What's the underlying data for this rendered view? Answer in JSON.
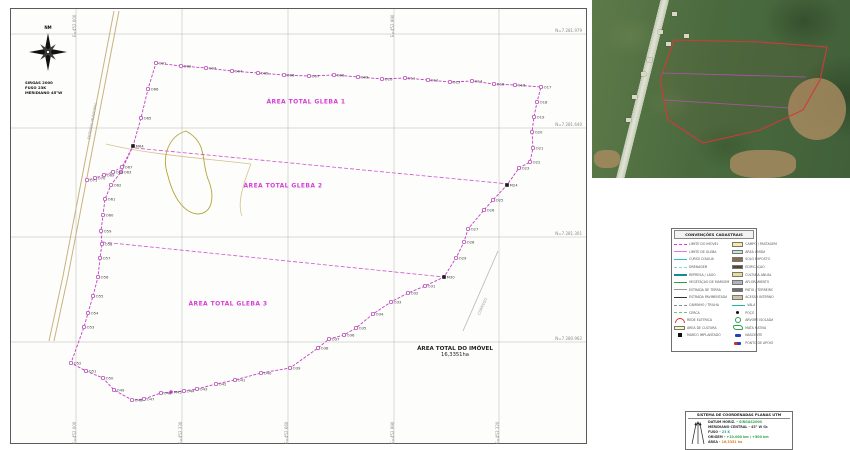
{
  "accent_colors": {
    "boundary": "#c43fc4",
    "gleba_text": "#d63fd6",
    "grid": "#b5b5b5",
    "road": "#c9b37e",
    "pond": "#b4a43c",
    "inset_boundary": "#d03a3a"
  },
  "compass": {
    "north_label": "NM",
    "datum_lines": [
      "SIRGAS 2000",
      "FUSO 23K",
      "MERIDIANO 45°W"
    ]
  },
  "map": {
    "gleba_labels": [
      {
        "text": "ÁREA TOTAL GLEBA 1",
        "x": 295,
        "y": 93
      },
      {
        "text": "ÁREA TOTAL GLEBA 2",
        "x": 272,
        "y": 177
      },
      {
        "text": "ÁREA TOTAL GLEBA 3",
        "x": 217,
        "y": 295
      }
    ],
    "area_label": {
      "line1": "ÁREA TOTAL DO IMÓVEL",
      "line2": "16,3351ha"
    },
    "road_label": "ESTRADA MUNICIPAL",
    "stream_label": "CÓRREGO",
    "grid": {
      "vertical_x": [
        65,
        171,
        277,
        383,
        488
      ],
      "horizontal_y": [
        25,
        119,
        228,
        333
      ],
      "north_labels": [
        "N=7.281.979",
        "N=7.281.640",
        "N=7.281.301",
        "N=7.280.962"
      ],
      "east_labels": [
        "E=452.000",
        "E=452.330",
        "E=452.660",
        "E=452.990",
        "E=453.320"
      ]
    },
    "shapes": {
      "road1": "M103,2 L78,132 L52,267 L38,332",
      "road2": "M108,2 L83,132 L57,267 L43,332",
      "pond": "M175,122 C158,127 150,147 157,167 C162,187 172,204 187,205 C202,204 204,187 197,170 C190,152 197,134 175,122 Z",
      "stream1": "M95,135 C140,146 200,150 240,155",
      "stream2": "M240,155 C232,175 226,195 231,207",
      "gray_stream": "M487,242 L452,322"
    },
    "division_lines": [
      [
        124,
        139,
        498,
        175
      ],
      [
        91,
        233,
        433,
        268
      ]
    ],
    "points": [
      [
        145,
        54,
        "O01",
        "o"
      ],
      [
        170,
        57,
        "O02",
        "o"
      ],
      [
        195,
        59,
        "O03",
        "o"
      ],
      [
        221,
        62,
        "O04",
        "o"
      ],
      [
        247,
        64,
        "O05",
        "o"
      ],
      [
        273,
        66,
        "O06",
        "o"
      ],
      [
        298,
        67,
        "O07",
        "o"
      ],
      [
        323,
        66,
        "O08",
        "o"
      ],
      [
        347,
        68,
        "O09",
        "o"
      ],
      [
        371,
        70,
        "O10",
        "o"
      ],
      [
        394,
        69,
        "O11",
        "o"
      ],
      [
        417,
        71,
        "O12",
        "o"
      ],
      [
        439,
        73,
        "O13",
        "o"
      ],
      [
        461,
        72,
        "O14",
        "o"
      ],
      [
        483,
        75,
        "O15",
        "o"
      ],
      [
        504,
        76,
        "O16",
        "o"
      ],
      [
        530,
        78,
        "O17",
        "o"
      ],
      [
        526,
        93,
        "O18",
        "o"
      ],
      [
        523,
        108,
        "O19",
        "o"
      ],
      [
        521,
        123,
        "O20",
        "o"
      ],
      [
        522,
        139,
        "O21",
        "o"
      ],
      [
        519,
        153,
        "O22",
        "o"
      ],
      [
        508,
        159,
        "O23",
        "o"
      ],
      [
        496,
        176,
        "M24",
        "m"
      ],
      [
        482,
        191,
        "O25",
        "o"
      ],
      [
        473,
        201,
        "O26",
        "o"
      ],
      [
        457,
        220,
        "O27",
        "o"
      ],
      [
        453,
        233,
        "O28",
        "o"
      ],
      [
        445,
        249,
        "O29",
        "o"
      ],
      [
        433,
        268,
        "M30",
        "m"
      ],
      [
        414,
        277,
        "O31",
        "o"
      ],
      [
        397,
        284,
        "O32",
        "o"
      ],
      [
        380,
        293,
        "O33",
        "o"
      ],
      [
        362,
        305,
        "O34",
        "o"
      ],
      [
        345,
        319,
        "O35",
        "o"
      ],
      [
        333,
        326,
        "O36",
        "o"
      ],
      [
        318,
        330,
        "O37",
        "o"
      ],
      [
        307,
        339,
        "O38",
        "o"
      ],
      [
        279,
        359,
        "O39",
        "o"
      ],
      [
        250,
        364,
        "O40",
        "o"
      ],
      [
        224,
        371,
        "O41",
        "o"
      ],
      [
        205,
        375,
        "O42",
        "o"
      ],
      [
        186,
        380,
        "O43",
        "o"
      ],
      [
        173,
        382,
        "O44",
        "o"
      ],
      [
        160,
        383,
        "M45",
        "f"
      ],
      [
        150,
        384,
        "O46",
        "o"
      ],
      [
        133,
        390,
        "O47",
        "o"
      ],
      [
        121,
        391,
        "O48",
        "o"
      ],
      [
        103,
        381,
        "O49",
        "o"
      ],
      [
        92,
        369,
        "O50",
        "o"
      ],
      [
        75,
        362,
        "O51",
        "o"
      ],
      [
        60,
        354,
        "O52",
        "o"
      ],
      [
        73,
        318,
        "O53",
        "o"
      ],
      [
        77,
        304,
        "O54",
        "o"
      ],
      [
        82,
        287,
        "O55",
        "o"
      ],
      [
        87,
        268,
        "O56",
        "o"
      ],
      [
        89,
        249,
        "O57",
        "o"
      ],
      [
        91,
        235,
        "O58",
        "o"
      ],
      [
        90,
        222,
        "O59",
        "o"
      ],
      [
        92,
        206,
        "O60",
        "o"
      ],
      [
        94,
        190,
        "O61",
        "o"
      ],
      [
        100,
        176,
        "O62",
        "o"
      ],
      [
        110,
        163,
        "O63",
        "o"
      ],
      [
        122,
        137,
        "M64",
        "m"
      ],
      [
        130,
        109,
        "O65",
        "o"
      ],
      [
        137,
        80,
        "O66",
        "o"
      ]
    ],
    "spur_points": [
      [
        111,
        158,
        "O67",
        "o"
      ],
      [
        102,
        163,
        "O68",
        "o"
      ],
      [
        93,
        166,
        "O69",
        "o"
      ],
      [
        84,
        169,
        "O70",
        "o"
      ],
      [
        76,
        171,
        "O71",
        "o"
      ]
    ]
  },
  "inset": {
    "boundary": [
      [
        82,
        40
      ],
      [
        168,
        42
      ],
      [
        235,
        47
      ],
      [
        228,
        80
      ],
      [
        211,
        110
      ],
      [
        168,
        130
      ],
      [
        111,
        143
      ],
      [
        76,
        120
      ],
      [
        68,
        80
      ]
    ],
    "division_lines": [
      [
        70,
        73,
        214,
        77
      ],
      [
        72,
        100,
        198,
        108
      ]
    ],
    "buildings": [
      [
        80,
        12
      ],
      [
        66,
        30
      ],
      [
        74,
        42
      ],
      [
        55,
        58
      ],
      [
        49,
        72
      ],
      [
        40,
        95
      ],
      [
        34,
        118
      ],
      [
        92,
        34
      ]
    ],
    "fields": [
      {
        "x": 196,
        "y": 78,
        "w": 58,
        "h": 62,
        "r": "50%"
      },
      {
        "x": 138,
        "y": 150,
        "w": 66,
        "h": 28,
        "r": "40%"
      },
      {
        "x": 2,
        "y": 150,
        "w": 26,
        "h": 18,
        "r": "40%"
      }
    ]
  },
  "legend": {
    "title": "CONVENÇÕES CADASTRAIS",
    "left": [
      {
        "type": "line",
        "color": "#d040d0",
        "dash": true,
        "label": "LIMITE DO IMÓVEL"
      },
      {
        "type": "line",
        "color": "#e07ae0",
        "dash": false,
        "label": "LIMITE DE GLEBA"
      },
      {
        "type": "line",
        "color": "#25c2c2",
        "dash": false,
        "label": "CURSO D'ÁGUA"
      },
      {
        "type": "line",
        "color": "#7adada",
        "dash": true,
        "label": "DRENAGEM"
      },
      {
        "type": "line",
        "color": "#0f8f8f",
        "thick": true,
        "label": "REPRESA / LAGO"
      },
      {
        "type": "line",
        "color": "#2ca04a",
        "dash": false,
        "label": "VEGETAÇÃO DE MARGEM"
      },
      {
        "type": "line",
        "color": "#9a9a9a",
        "dash": false,
        "label": "ESTRADA DE TERRA"
      },
      {
        "type": "line",
        "color": "#333333",
        "dash": false,
        "label": "ESTRADA PAVIMENTADA"
      },
      {
        "type": "line",
        "color": "#8a8a8a",
        "dash": true,
        "label": "CAMINHO / TRILHA"
      },
      {
        "type": "line",
        "color": "#6fc46f",
        "dash": true,
        "label": "CERCA"
      },
      {
        "type": "sym",
        "shape": "arc",
        "color": "#d03030",
        "label": "REDE ELÉTRICA"
      },
      {
        "type": "patch",
        "color": "#fbf7b0",
        "label": "ÁREA DE CULTURA"
      },
      {
        "type": "sym",
        "shape": "sq",
        "color": "#111111",
        "label": "MARCO IMPLANTADO"
      }
    ],
    "right": [
      {
        "type": "patch",
        "color": "#f2eda0",
        "label": "CAMPO / PASTAGEM"
      },
      {
        "type": "patch",
        "color": "#bfe8e4",
        "label": "ÁREA ÚMIDA"
      },
      {
        "type": "patch",
        "color": "#8a6d4b",
        "label": "SOLO EXPOSTO"
      },
      {
        "type": "patch",
        "color": "#57452f",
        "label": "EDIFICAÇÃO"
      },
      {
        "type": "patch",
        "color": "#e8e08e",
        "label": "CULTURA ANUAL"
      },
      {
        "type": "patch",
        "color": "#b5b5b5",
        "label": "AFLORAMENTO"
      },
      {
        "type": "patch",
        "color": "#6e6e6e",
        "label": "PÁTIO / TERREIRO"
      },
      {
        "type": "patch",
        "color": "#cfc5a5",
        "label": "ACESSO INTERNO"
      },
      {
        "type": "line",
        "color": "#1fb5a5",
        "dash": false,
        "label": "VALA"
      },
      {
        "type": "sym",
        "shape": "dot",
        "color": "#111111",
        "label": "POÇO"
      },
      {
        "type": "sym",
        "shape": "circle",
        "color": "#2ca04a",
        "label": "ÁRVORE ISOLADA"
      },
      {
        "type": "sym",
        "shape": "squiggle",
        "color": "#2ca04a",
        "label": "MATA NATIVA"
      },
      {
        "type": "sym",
        "shape": "blue",
        "color": "#2040c0",
        "label": "NASCENTE"
      },
      {
        "type": "sym",
        "shape": "redblue",
        "color": "#d03030",
        "label": "PONTO DE APOIO"
      }
    ]
  },
  "utm": {
    "title": "SISTEMA DE COORDENADAS PLANAS UTM",
    "rows": [
      {
        "label": "DATUM HORIZ.",
        "value": "SIRGAS2000",
        "vcolor": "#2ea44f"
      },
      {
        "label": "MERIDIANO CENTRAL",
        "value": "45° W Gr.",
        "vcolor": "#444444"
      },
      {
        "label": "FUSO",
        "value": "23 K",
        "vcolor": "#2ea4a4"
      },
      {
        "label": "ORIGEM",
        "value": "+10.000 km / +500 km",
        "vcolor": "#2ea44f"
      },
      {
        "label": "ÁREA",
        "value": "16,3351 ha",
        "vcolor": "#d08020"
      }
    ]
  }
}
